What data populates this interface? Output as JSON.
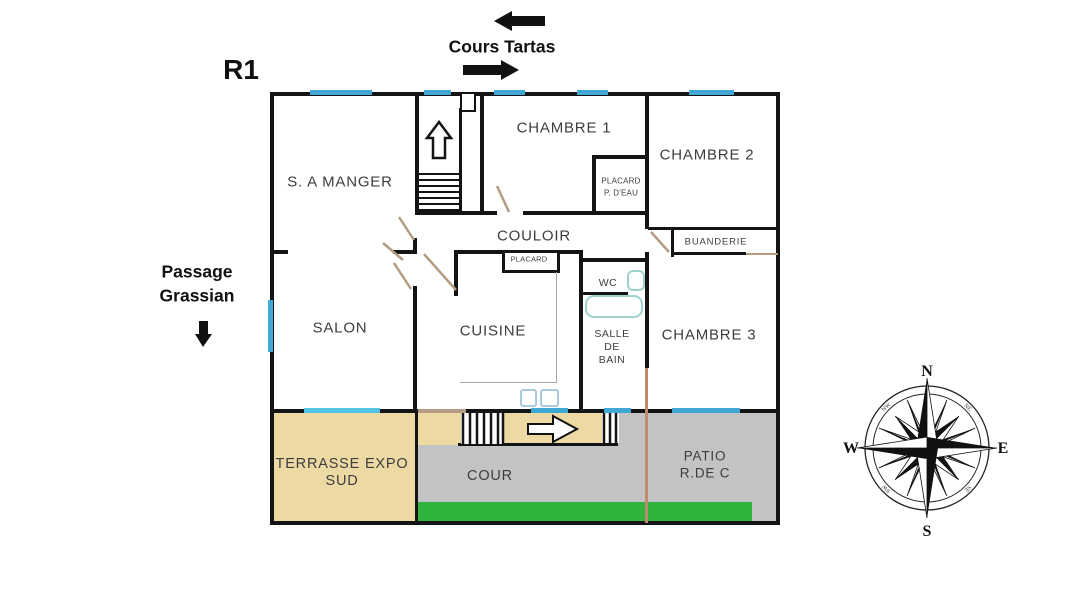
{
  "plan": {
    "floor_label": "R1"
  },
  "streets": {
    "top": "Cours Tartas",
    "left_line1": "Passage",
    "left_line2": "Grassian"
  },
  "rooms": {
    "dining_room": "S. A MANGER",
    "bedroom_1": "CHAMBRE 1",
    "bedroom_2": "CHAMBRE 2",
    "corridor": "COULOIR",
    "living_room": "SALON",
    "kitchen": "CUISINE",
    "bedroom_3": "CHAMBRE 3",
    "wc": "WC",
    "bathroom_line1": "SALLE",
    "bathroom_line2": "DE",
    "bathroom_line3": "BAIN",
    "closet_corridor": "PLACARD",
    "closet_bedroom1_line1": "PLACARD",
    "closet_bedroom1_line2": "P. D'EAU",
    "laundry": "BUANDERIE",
    "terrace_line1": "TERRASSE EXPO",
    "terrace_line2": "SUD",
    "courtyard": "COUR",
    "patio_line1": "PATIO",
    "patio_line2": "R.DE C"
  },
  "compass": {
    "north": "N",
    "east": "E",
    "south": "S",
    "west": "W",
    "northeast": "NE",
    "southeast": "SE",
    "southwest": "SW",
    "northwest": "NW"
  },
  "colors": {
    "wall": "#141414",
    "window_blue": "#3fa8d4",
    "window_cyan": "#52c5e5",
    "door_tan": "#b49c82",
    "terrace_fill": "#ecd9a4",
    "courtyard_gray": "#c3c3c3",
    "grass_green": "#2db53c",
    "fixture_teal": "#9ed2cd",
    "boundary_brown": "#c08a6e"
  }
}
